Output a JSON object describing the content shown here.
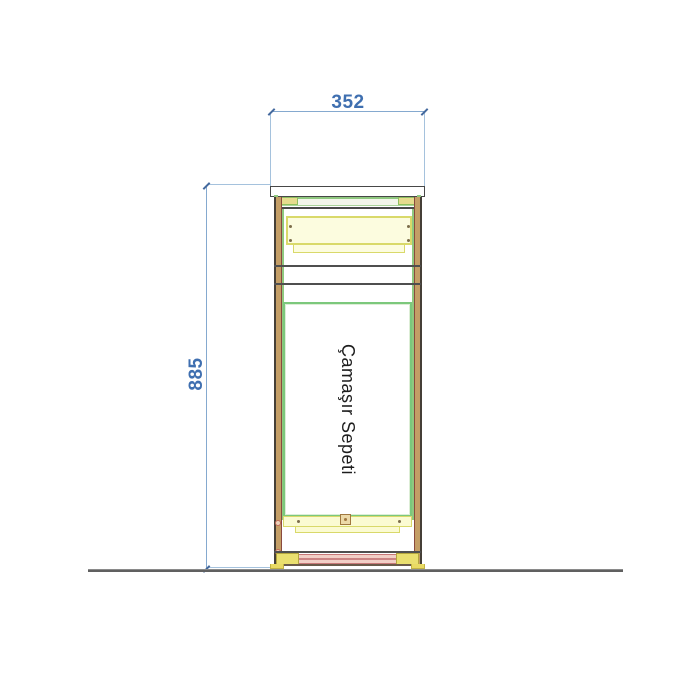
{
  "drawing": {
    "label": "Çamaşır Sepeti",
    "width_dim": "352",
    "height_dim": "885",
    "colors": {
      "dimension_line": "#85a9cf",
      "dimension_text": "#3f6fb0",
      "outline": "#4a4a4a",
      "panel_green": "#7cc87c",
      "hardware_yellow_fill": "#fbfbd2",
      "hardware_yellow_border": "#d9d96a",
      "side_tan": "#c49e66",
      "side_brown": "#8a4a3e",
      "plinth_pink": "#cc8484",
      "ground": "#606060",
      "label_text": "#1d1d1d"
    }
  }
}
